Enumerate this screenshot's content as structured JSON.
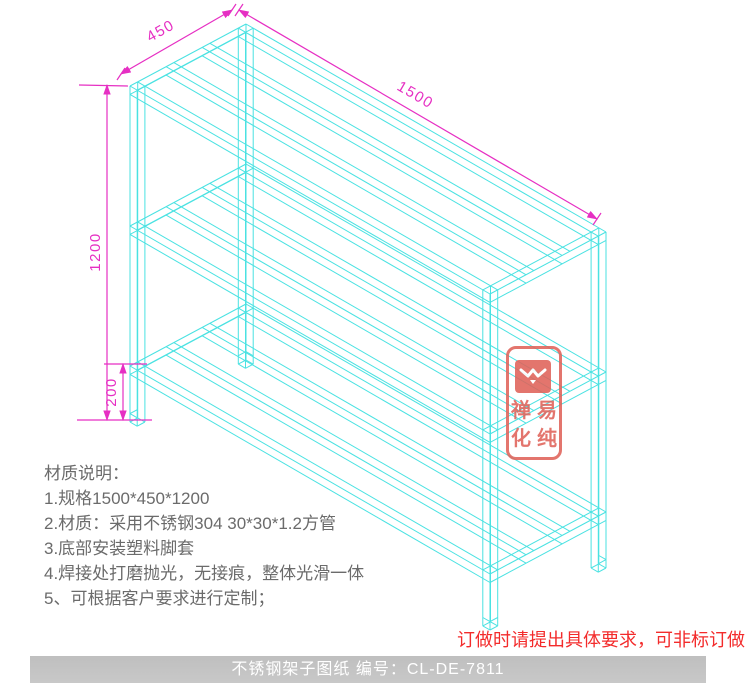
{
  "drawing": {
    "type": "isometric-wireframe",
    "subject": "stainless steel 3-tier rack",
    "dimensions": {
      "depth": "450",
      "length": "1500",
      "height": "1200",
      "bottom_clearance": "200"
    }
  },
  "colors": {
    "wireframe": "#4ae2e2",
    "dimension": "#e62fc3",
    "warning_red": "#f32b2b",
    "stamp_red": "#e0635a",
    "note_gray": "#6b6b6b",
    "footer_bar": "#c3c3c3",
    "footer_text": "#ffffff"
  },
  "notes": {
    "title": "材质说明：",
    "lines": [
      "1.规格1500*450*1200",
      "2.材质：采用不锈钢304 30*30*1.2方管",
      "3.底部安装塑料脚套",
      "4.焊接处打磨抛光，无接痕，整体光滑一体",
      "5、可根据客户要求进行定制；"
    ]
  },
  "warning": {
    "text": "订做时请提出具体要求，可非标订做"
  },
  "footer": {
    "text": "不锈钢架子图纸  编号：CL-DE-7811"
  },
  "stamp": {
    "chars": [
      "禅",
      "易",
      "化",
      "纯"
    ],
    "logo": "bird-wings-logo"
  }
}
